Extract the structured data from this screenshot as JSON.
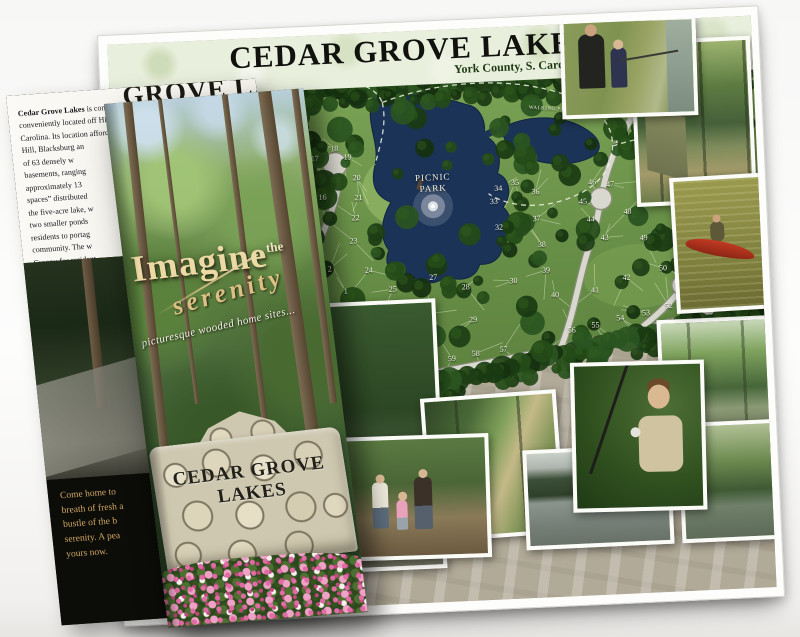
{
  "poster": {
    "title": "CEDAR GROVE LAKES",
    "subtitle": "York County, S. Carolina",
    "map": {
      "picnic_park_label": "PICNIC PARK",
      "walking_path_label_1": "WALKING PATH",
      "walking_path_label_2": "WALKING PATH",
      "partial_edge_label": "etic",
      "lots": [
        {
          "n": "1",
          "x": 227,
          "y": 257
        },
        {
          "n": "2",
          "x": 212,
          "y": 234
        },
        {
          "n": "16",
          "x": 208,
          "y": 162
        },
        {
          "n": "17",
          "x": 202,
          "y": 123
        },
        {
          "n": "18",
          "x": 222,
          "y": 114
        },
        {
          "n": "19",
          "x": 235,
          "y": 123
        },
        {
          "n": "20",
          "x": 243,
          "y": 144
        },
        {
          "n": "21",
          "x": 244,
          "y": 164
        },
        {
          "n": "22",
          "x": 240,
          "y": 184
        },
        {
          "n": "23",
          "x": 237,
          "y": 207
        },
        {
          "n": "24",
          "x": 251,
          "y": 237
        },
        {
          "n": "25",
          "x": 274,
          "y": 257
        },
        {
          "n": "26",
          "x": 312,
          "y": 283
        },
        {
          "n": "27",
          "x": 315,
          "y": 247
        },
        {
          "n": "28",
          "x": 347,
          "y": 258
        },
        {
          "n": "29",
          "x": 353,
          "y": 291
        },
        {
          "n": "30",
          "x": 395,
          "y": 254
        },
        {
          "n": "32",
          "x": 383,
          "y": 200
        },
        {
          "n": "33",
          "x": 379,
          "y": 174
        },
        {
          "n": "34",
          "x": 384,
          "y": 161
        },
        {
          "n": "35",
          "x": 401,
          "y": 156
        },
        {
          "n": "36",
          "x": 421,
          "y": 166
        },
        {
          "n": "37",
          "x": 421,
          "y": 193
        },
        {
          "n": "38",
          "x": 425,
          "y": 219
        },
        {
          "n": "39",
          "x": 428,
          "y": 245
        },
        {
          "n": "40",
          "x": 436,
          "y": 270
        },
        {
          "n": "41",
          "x": 476,
          "y": 267
        },
        {
          "n": "42",
          "x": 508,
          "y": 256
        },
        {
          "n": "43",
          "x": 488,
          "y": 215
        },
        {
          "n": "44",
          "x": 475,
          "y": 196
        },
        {
          "n": "45",
          "x": 468,
          "y": 178
        },
        {
          "n": "46",
          "x": 478,
          "y": 159
        },
        {
          "n": "47",
          "x": 496,
          "y": 162
        },
        {
          "n": "48",
          "x": 512,
          "y": 190
        },
        {
          "n": "49",
          "x": 527,
          "y": 217
        },
        {
          "n": "50",
          "x": 545,
          "y": 248
        },
        {
          "n": "51",
          "x": 575,
          "y": 279
        },
        {
          "n": "52",
          "x": 549,
          "y": 286
        },
        {
          "n": "53",
          "x": 526,
          "y": 292
        },
        {
          "n": "54",
          "x": 500,
          "y": 296
        },
        {
          "n": "55",
          "x": 475,
          "y": 302
        },
        {
          "n": "56",
          "x": 451,
          "y": 306
        },
        {
          "n": "57",
          "x": 382,
          "y": 322
        },
        {
          "n": "58",
          "x": 354,
          "y": 325
        },
        {
          "n": "59",
          "x": 330,
          "y": 329
        },
        {
          "n": "60",
          "x": 312,
          "y": 327
        },
        {
          "n": "61",
          "x": 293,
          "y": 318
        },
        {
          "n": "62",
          "x": 275,
          "y": 305
        },
        {
          "n": "63",
          "x": 257,
          "y": 288
        }
      ]
    },
    "colors": {
      "map_water": "#1b3357",
      "map_lawn": "#6f9449",
      "map_tree": "#1d3d14",
      "poster_band": "#b2aa98",
      "brochure_gold": "#d2a964",
      "flower_pink": "#e06ba5"
    }
  },
  "brochure": {
    "back_panel": {
      "header_partial": "GROVE LAKES",
      "paragraph_lead": "Cedar Grove Lakes",
      "paragraph_lines": [
        " is comprised of a 108 ac",
        "conveniently located off Highway",
        "Carolina. Its location afford",
        "Hill, Blacksburg an",
        "of 63 densely w",
        "basements, ranging",
        "approximately 13",
        "spaces” distributed",
        "the five-acre lake, w",
        "two smaller ponds",
        "residents to portag",
        "community. The w",
        "Croppy for resident"
      ],
      "message_lines": [
        "Come home to",
        "breath of fresh a",
        "bustle of the b",
        "serenity. A pea",
        "yours now."
      ],
      "contact_lines": [
        "Fo",
        "call: 7",
        "or visit w"
      ]
    },
    "cover": {
      "headline": "Imagine",
      "headline_sup": "the",
      "script_word": "serenity",
      "tagline": "picturesque wooded home sites...",
      "sign_line1": "CEDAR GROVE",
      "sign_line2": "LAKES"
    }
  }
}
